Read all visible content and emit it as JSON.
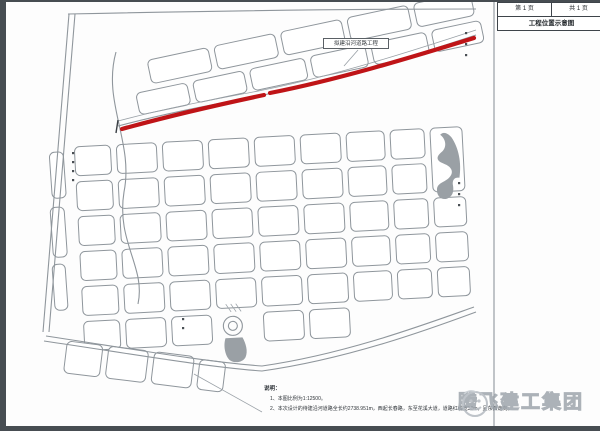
{
  "title_block": {
    "page_label": "第 1 页",
    "total_label": "共 1 页",
    "title": "工程位置示意图"
  },
  "road_label": {
    "text": "拟建沿河道路工程"
  },
  "notes": {
    "heading": "说明：",
    "items": [
      "1、本图比例为1:12500。",
      "2、本次设计的待建沿河道路全长约2738.951m，西起长春路，东至花溪大道，道路红线宽30m，呈东西走向。"
    ]
  },
  "watermark": {
    "text": "腾飞建工集团",
    "logo": "tengfei-logo"
  },
  "colors": {
    "highlight_road": "#bf1417",
    "map_line": "#8f969c",
    "water_fill": "#9aa0a5",
    "frame": "#474d52"
  }
}
